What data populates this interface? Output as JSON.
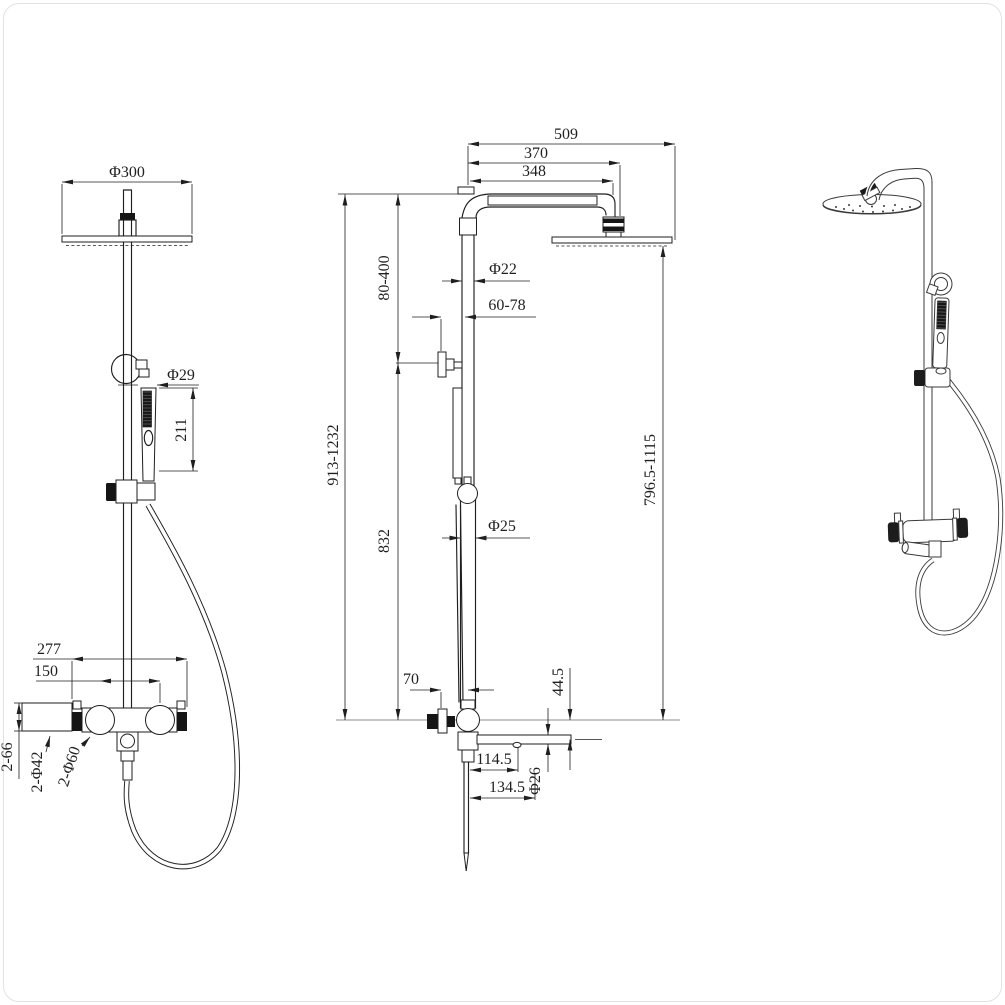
{
  "meta": {
    "type": "technical-dimension-drawing",
    "subject": "wall-mounted shower column with overhead shower, hand shower and dual-handle mixer",
    "views": [
      "front-view",
      "side-view",
      "perspective-view"
    ]
  },
  "colors": {
    "background": "#ffffff",
    "line": "#1f1f1f",
    "render_line": "#3a3a3a"
  },
  "drawing": {
    "front": {
      "phi300": "Φ300",
      "phi29": "Φ29",
      "len211": "211",
      "width277": "277",
      "spacing150": "150",
      "depth66": "2-66",
      "esc42": "2-Φ42",
      "handle60": "2-Φ60"
    },
    "side": {
      "reach509": "509",
      "reach370": "370",
      "arm348": "348",
      "upper80_400": "80-400",
      "pipe22": "Φ22",
      "wall60_78": "60-78",
      "total913_1232": "913-1232",
      "lower832": "832",
      "pipe25": "Φ25",
      "head796": "796.5-1115",
      "offset70": "70",
      "drop44_5": "44.5",
      "spout114_5": "114.5",
      "spout26": "Φ26",
      "spout134_5": "134.5"
    }
  }
}
